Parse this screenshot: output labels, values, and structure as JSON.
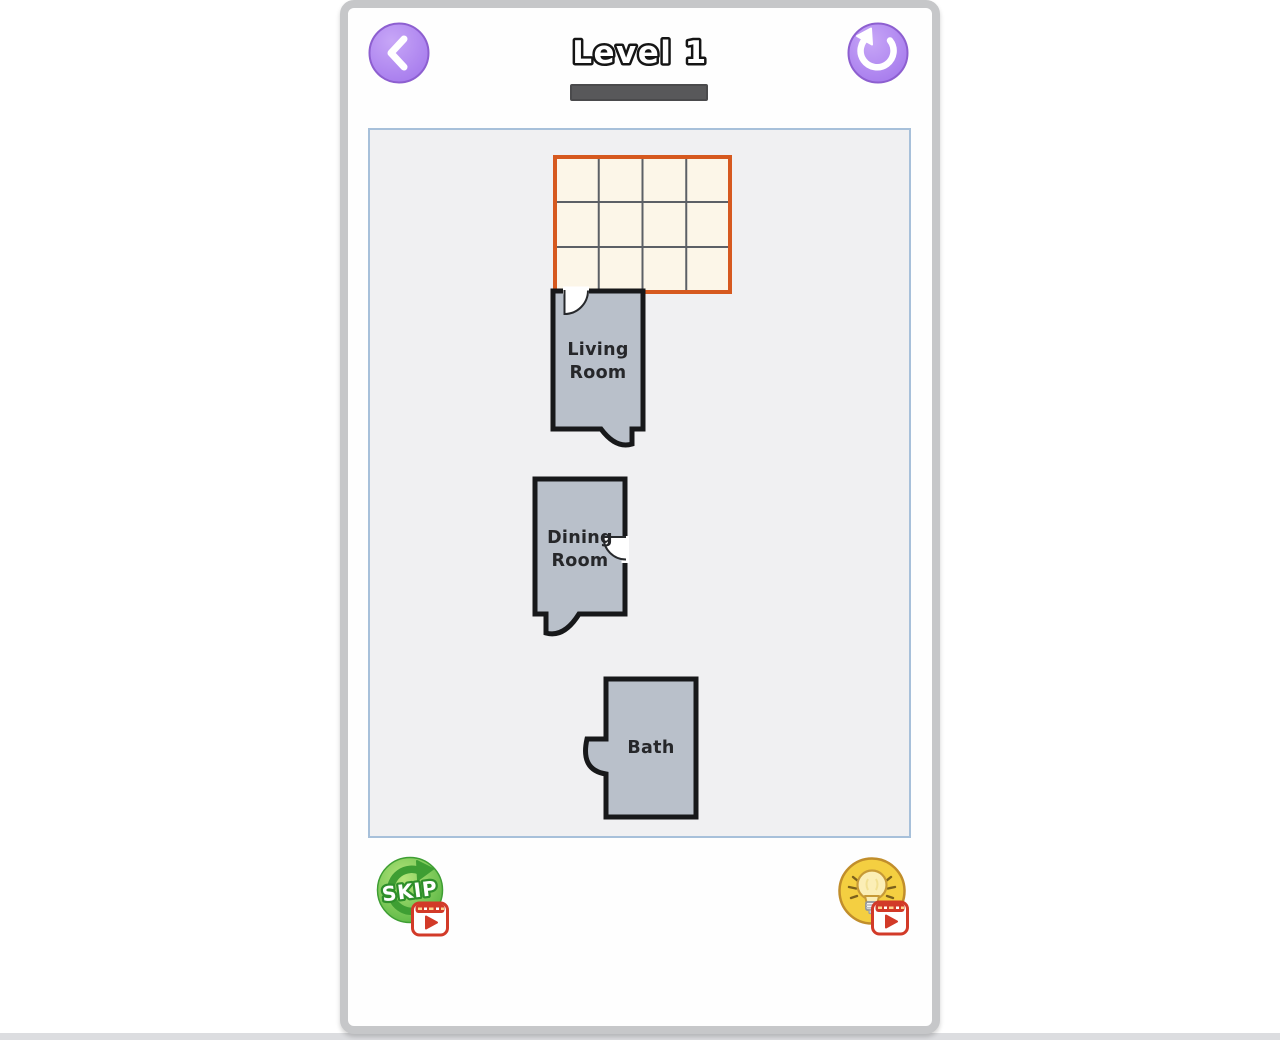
{
  "header": {
    "title": "Level 1",
    "back_icon": "chevron-left",
    "restart_icon": "undo-arrow",
    "button_color": "#a77ced",
    "progress_color": "#58585a"
  },
  "board": {
    "grid": {
      "rows": 3,
      "cols": 4,
      "cell_color": "#fcf6e8",
      "border_color": "#d6591f",
      "line_color": "#5c6066"
    },
    "rooms": [
      {
        "id": "living-room",
        "lines": [
          "Living",
          "Room"
        ]
      },
      {
        "id": "dining-room",
        "lines": [
          "Dining",
          "Room"
        ]
      },
      {
        "id": "bath",
        "lines": [
          "Bath"
        ]
      }
    ],
    "room_fill": "#b9c0ca",
    "room_border": "#17181a",
    "play_area_bg": "#f0f0f2",
    "play_area_border": "#a7c0da"
  },
  "footer": {
    "skip_label": "SKIP",
    "skip_color": "#58b643",
    "hint_icon": "lightbulb",
    "hint_color": "#f4cf41",
    "ad_badge_color": "#d23a28"
  }
}
